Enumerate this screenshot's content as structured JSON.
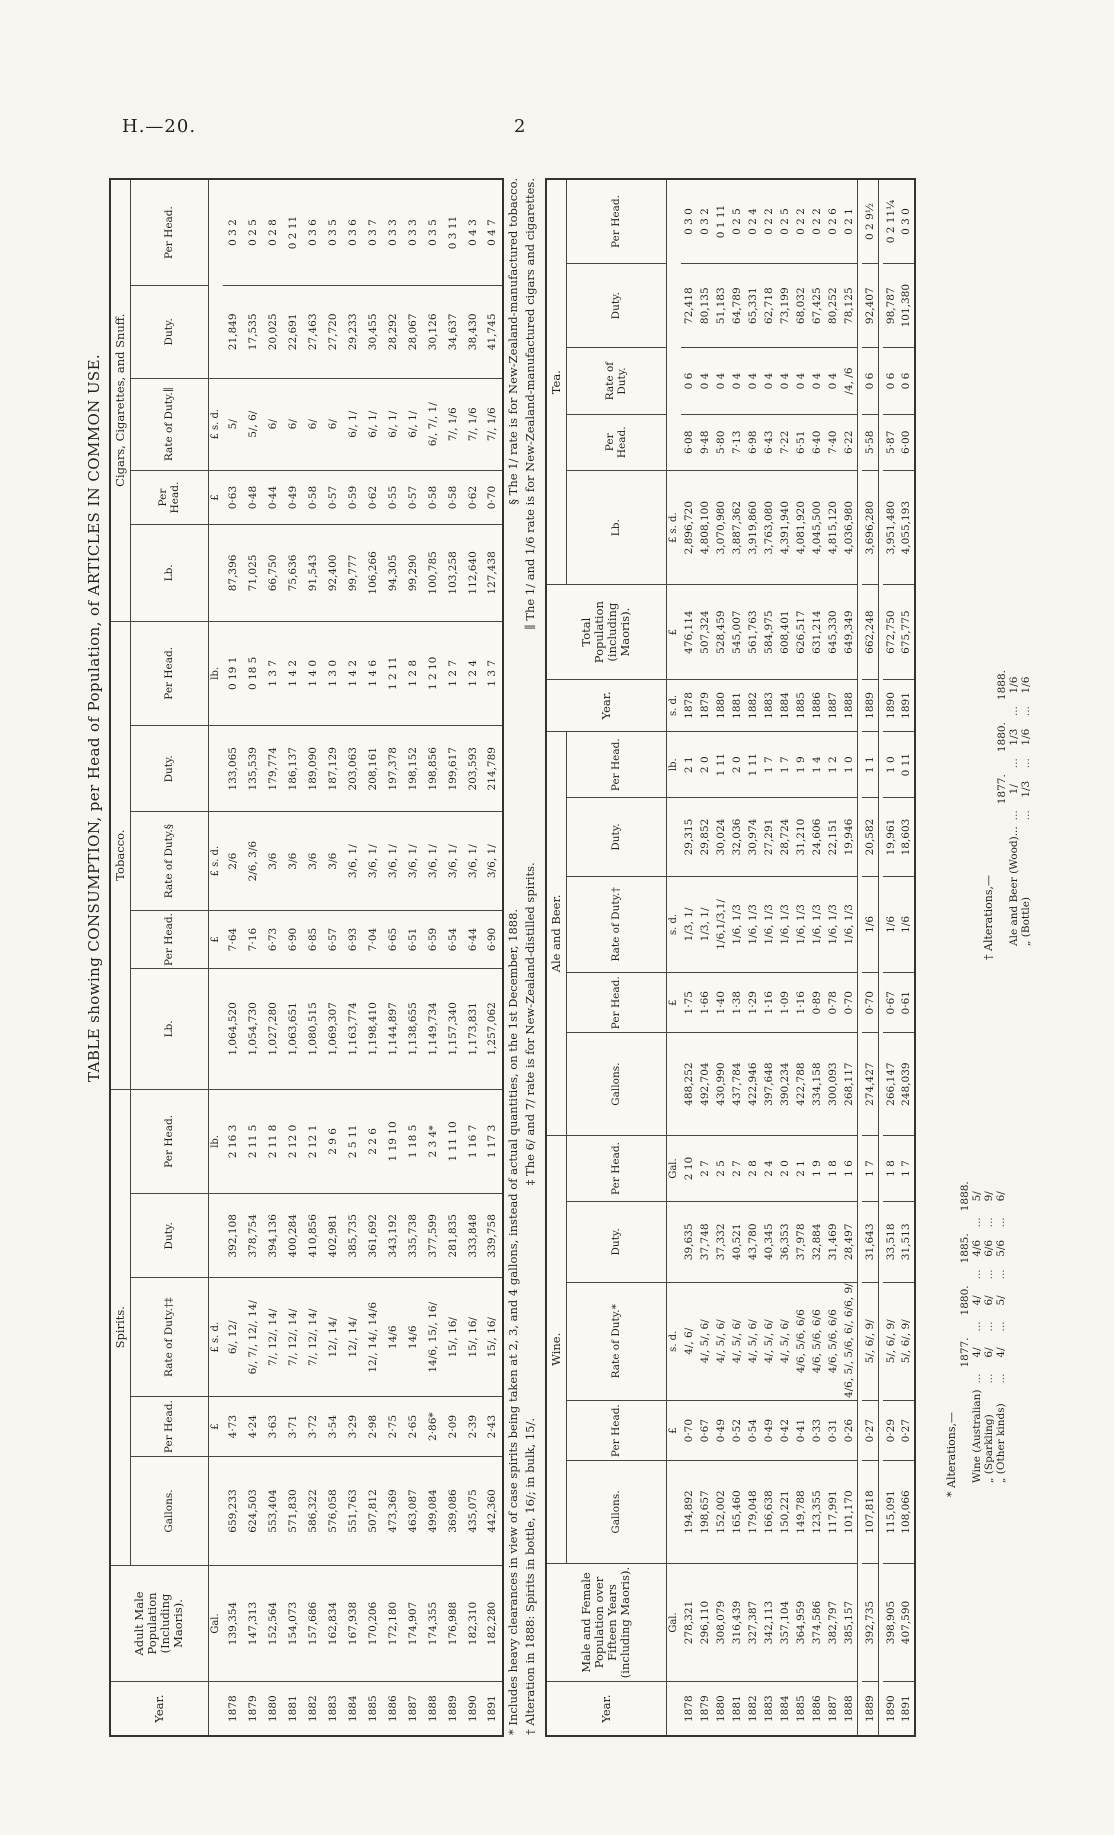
{
  "page": {
    "header_left": "H.—20.",
    "page_number": "2"
  },
  "title": "TABLE showing CONSUMPTION, per Head of Population, of ARTICLES IN COMMON USE.",
  "table1": {
    "head": {
      "year": "Year.",
      "pop": "Adult Male Population (Including Maoris)."
    },
    "groups": [
      "Spirits.",
      "Tobacco.",
      "Cigars, Cigarettes, and Snuff."
    ],
    "sub_headers": [
      "Gallons.",
      "Per Head.",
      "Rate of Duty.†‡",
      "Duty.",
      "Per Head.",
      "Lb.",
      "Per Head.",
      "Rate of Duty.§",
      "Duty.",
      "Per Head.",
      "Lb.",
      "Per Head.",
      "Rate of Duty.∥",
      "Duty.",
      "Per Head."
    ],
    "units": [
      "",
      "Gal.",
      "",
      "£",
      "£ s. d.",
      "",
      "lb.",
      "",
      "£",
      "£ s. d.",
      "",
      "lb.",
      "",
      "£",
      "£ s. d."
    ],
    "rows": [
      [
        "1878",
        "139,354",
        "659,233",
        "4·73",
        "6/, 12/",
        "392,108",
        "2 16 3",
        "1,064,520",
        "7·64",
        "2/6",
        "133,065",
        "0 19 1",
        "87,396",
        "0·63",
        "5/",
        "21,849",
        "0 3 2"
      ],
      [
        "1879",
        "147,313",
        "624,503",
        "4·24",
        "6/, 7/, 12/, 14/",
        "378,754",
        "2 11 5",
        "1,054,730",
        "7·16",
        "2/6, 3/6",
        "135,539",
        "0 18 5",
        "71,025",
        "0·48",
        "5/, 6/",
        "17,535",
        "0 2 5"
      ],
      [
        "1880",
        "152,564",
        "553,404",
        "3·63",
        "7/, 12/, 14/",
        "394,136",
        "2 11 8",
        "1,027,280",
        "6·73",
        "3/6",
        "179,774",
        "1 3 7",
        "66,750",
        "0·44",
        "6/",
        "20,025",
        "0 2 8"
      ],
      [
        "1881",
        "154,073",
        "571,830",
        "3·71",
        "7/, 12/, 14/",
        "400,284",
        "2 12 0",
        "1,063,651",
        "6·90",
        "3/6",
        "186,137",
        "1 4 2",
        "75,636",
        "0·49",
        "6/",
        "22,691",
        "0 2 11"
      ],
      [
        "1882",
        "157,686",
        "586,322",
        "3·72",
        "7/, 12/, 14/",
        "410,856",
        "2 12 1",
        "1,080,515",
        "6·85",
        "3/6",
        "189,090",
        "1 4 0",
        "91,543",
        "0·58",
        "6/",
        "27,463",
        "0 3 6"
      ],
      [
        "1883",
        "162,834",
        "576,058",
        "3·54",
        "12/, 14/",
        "402,981",
        "2 9 6",
        "1,069,307",
        "6·57",
        "3/6",
        "187,129",
        "1 3 0",
        "92,400",
        "0·57",
        "6/",
        "27,720",
        "0 3 5"
      ],
      [
        "1884",
        "167,938",
        "551,763",
        "3·29",
        "12/, 14/",
        "385,735",
        "2 5 11",
        "1,163,774",
        "6·93",
        "3/6, 1/",
        "203,063",
        "1 4 2",
        "99,777",
        "0·59",
        "6/, 1/",
        "29,233",
        "0 3 6"
      ],
      [
        "1885",
        "170,206",
        "507,812",
        "2·98",
        "12/, 14/, 14/6",
        "361,692",
        "2 2 6",
        "1,198,410",
        "7·04",
        "3/6, 1/",
        "208,161",
        "1 4 6",
        "106,266",
        "0·62",
        "6/, 1/",
        "30,455",
        "0 3 7"
      ],
      [
        "1886",
        "172,180",
        "473,369",
        "2·75",
        "14/6",
        "343,192",
        "1 19 10",
        "1,144,897",
        "6·65",
        "3/6, 1/",
        "197,378",
        "1 2 11",
        "94,305",
        "0·55",
        "6/, 1/",
        "28,292",
        "0 3 3"
      ],
      [
        "1887",
        "174,907",
        "463,087",
        "2·65",
        "14/6",
        "335,738",
        "1 18 5",
        "1,138,655",
        "6·51",
        "3/6, 1/",
        "198,152",
        "1 2 8",
        "99,290",
        "0·57",
        "6/, 1/",
        "28,067",
        "0 3 3"
      ],
      [
        "1888",
        "174,355",
        "499,084",
        "2·86*",
        "14/6, 15/, 16/",
        "377,599",
        "2 3 4*",
        "1,149,734",
        "6·59",
        "3/6, 1/",
        "198,856",
        "1 2 10",
        "100,785",
        "0·58",
        "6/, 7/, 1/",
        "30,126",
        "0 3 5"
      ],
      [
        "1889",
        "176,988",
        "369,086",
        "2·09",
        "15/, 16/",
        "281,835",
        "1 11 10",
        "1,157,340",
        "6·54",
        "3/6, 1/",
        "199,617",
        "1 2 7",
        "103,258",
        "0·58",
        "7/, 1/6",
        "34,637",
        "0 3 11"
      ],
      [
        "1890",
        "182,310",
        "435,075",
        "2·39",
        "15/, 16/",
        "333,848",
        "1 16 7",
        "1,173,831",
        "6·44",
        "3/6, 1/",
        "203,593",
        "1 2 4",
        "112,640",
        "0·62",
        "7/, 1/6",
        "38,430",
        "0 4 3"
      ],
      [
        "1891",
        "182,280",
        "442,360",
        "2·43",
        "15/, 16/",
        "339,758",
        "1 17 3",
        "1,257,062",
        "6·90",
        "3/6, 1/",
        "214,789",
        "1 3 7",
        "127,438",
        "0·70",
        "7/, 1/6",
        "41,745",
        "0 4 7"
      ]
    ]
  },
  "footnotes": {
    "line1a": "* Includes heavy clearances in view of case spirits being taken at 2, 3, and 4 gallons, instead of actual quantities, on the 1st December, 1888.",
    "line1b": "§ The 1/ rate is for New-Zealand-manufactured tobacco.",
    "line2a": "† Alteration in 1888: Spirits in bottle, 16/; in bulk, 15/.",
    "line2b": "‡ The 6/ and 7/ rate is for New-Zealand-distilled spirits.",
    "line2c": "∥ The 1/ and 1/6 rate is for New-Zealand-manufactured cigars and cigarettes."
  },
  "table2": {
    "head": {
      "year": "Year.",
      "pop": "Male and Female Population over Fifteen Years (includ­ing Maoris).",
      "year2": "Year.",
      "total": "Total Population (including Maoris)."
    },
    "groups": [
      "Wine.",
      "Ale and Beer.",
      "Tea."
    ],
    "sub_headers": [
      "Gallons.",
      "Per Head.",
      "Rate of Duty.*",
      "Duty.",
      "Per Head.",
      "Gallons.",
      "Per Head.",
      "Rate of Duty.†",
      "Duty.",
      "Per Head.",
      "Lb.",
      "Per Head.",
      "Rate of Duty.",
      "Duty.",
      "Per Head."
    ],
    "units": [
      "",
      "Gal.",
      "",
      "£",
      "s. d.",
      "",
      "Gal.",
      "",
      "£",
      "s. d.",
      "",
      "lb.",
      "s. d.",
      "£",
      "£ s. d."
    ],
    "rows": [
      [
        "1878",
        "278,321",
        "194,892",
        "0·70",
        "4/, 6/",
        "39,635",
        "2 10",
        "488,252",
        "1·75",
        "1/3, 1/",
        "29,315",
        "2 1",
        "1878",
        "476,114",
        "2,896,720",
        "6·08",
        "0 6",
        "72,418",
        "0 3 0"
      ],
      [
        "1879",
        "296,110",
        "198,657",
        "0·67",
        "4/, 5/, 6/",
        "37,748",
        "2 7",
        "492,704",
        "1·66",
        "1/3, 1/",
        "29,852",
        "2 0",
        "1879",
        "507,324",
        "4,808,100",
        "9·48",
        "0 4",
        "80,135",
        "0 3 2"
      ],
      [
        "1880",
        "308,079",
        "152,002",
        "0·49",
        "4/, 5/, 6/",
        "37,332",
        "2 5",
        "430,990",
        "1·40",
        "1/6,1/3,1/",
        "30,024",
        "1 11",
        "1880",
        "528,459",
        "3,070,980",
        "5·80",
        "0 4",
        "51,183",
        "0 1 11"
      ],
      [
        "1881",
        "316,439",
        "165,460",
        "0·52",
        "4/, 5/, 6/",
        "40,521",
        "2 7",
        "437,784",
        "1·38",
        "1/6, 1/3",
        "32,036",
        "2 0",
        "1881",
        "545,007",
        "3,887,362",
        "7·13",
        "0 4",
        "64,789",
        "0 2 5"
      ],
      [
        "1882",
        "327,387",
        "179,048",
        "0·54",
        "4/, 5/, 6/",
        "43,780",
        "2 8",
        "422,946",
        "1·29",
        "1/6, 1/3",
        "30,974",
        "1 11",
        "1882",
        "561,763",
        "3,919,860",
        "6·98",
        "0 4",
        "65,331",
        "0 2 4"
      ],
      [
        "1883",
        "342,113",
        "166,638",
        "0·49",
        "4/, 5/, 6/",
        "40,345",
        "2 4",
        "397,648",
        "1·16",
        "1/6, 1/3",
        "27,291",
        "1 7",
        "1883",
        "584,975",
        "3,763,080",
        "6·43",
        "0 4",
        "62,718",
        "0 2 2"
      ],
      [
        "1884",
        "357,104",
        "150,221",
        "0·42",
        "4/, 5/, 6/",
        "36,353",
        "2 0",
        "390,234",
        "1·09",
        "1/6, 1/3",
        "28,724",
        "1 7",
        "1884",
        "608,401",
        "4,391,940",
        "7·22",
        "0 4",
        "73,199",
        "0 2 5"
      ],
      [
        "1885",
        "364,959",
        "149,788",
        "0·41",
        "4/6, 5/6, 6/6",
        "37,978",
        "2 1",
        "422,788",
        "1·16",
        "1/6, 1/3",
        "31,210",
        "1 9",
        "1885",
        "626,517",
        "4,081,920",
        "6·51",
        "0 4",
        "68,032",
        "0 2 2"
      ],
      [
        "1886",
        "374,586",
        "123,355",
        "0·33",
        "4/6, 5/6, 6/6",
        "32,884",
        "1 9",
        "334,158",
        "0·89",
        "1/6, 1/3",
        "24,606",
        "1 4",
        "1886",
        "631,214",
        "4,045,500",
        "6·40",
        "0 4",
        "67,425",
        "0 2 2"
      ],
      [
        "1887",
        "382,797",
        "117,991",
        "0·31",
        "4/6, 5/6, 6/6",
        "31,469",
        "1 8",
        "300,093",
        "0·78",
        "1/6, 1/3",
        "22,151",
        "1 2",
        "1887",
        "645,330",
        "4,815,120",
        "7·40",
        "0 4",
        "80,252",
        "0 2 6"
      ],
      [
        "1888",
        "385,157",
        "101,170",
        "0·26",
        "4/6, 5/, 5/6, 6/, 6/6, 9/",
        "28,497",
        "1 6",
        "268,117",
        "0·70",
        "1/6, 1/3",
        "19,946",
        "1 0",
        "1888",
        "649,349",
        "4,036,980",
        "6·22",
        "/4, /6",
        "78,125",
        "0 2 1"
      ],
      [
        "1889",
        "392,735",
        "107,818",
        "0·27",
        "5/, 6/, 9/",
        "31,643",
        "1 7",
        "274,427",
        "0·70",
        "1/6",
        "20,582",
        "1 1",
        "1889",
        "662,248",
        "3,696,280",
        "5·58",
        "0 6",
        "92,407",
        "0 2 9½"
      ],
      [
        "1890",
        "398,905",
        "115,091",
        "0·29",
        "5/, 6/, 9/",
        "33,518",
        "1 8",
        "266,147",
        "0·67",
        "1/6",
        "19,961",
        "1 0",
        "1890",
        "672,750",
        "3,951,480",
        "5·87",
        "0 6",
        "98,787",
        "0 2 11¼"
      ],
      [
        "1891",
        "407,590",
        "108,066",
        "0·27",
        "5/, 6/, 9/",
        "31,513",
        "1 7",
        "248,039",
        "0·61",
        "1/6",
        "18,603",
        "0 11",
        "1891",
        "675,775",
        "4,055,193",
        "6·00",
        "0 6",
        "101,380",
        "0 3 0"
      ]
    ],
    "group_breaks": [
      11,
      12
    ]
  },
  "alterations_wine": {
    "title": "* Alterations,—",
    "years": [
      "1877.",
      "1880.",
      "1885.",
      "1888."
    ],
    "leader": "...",
    "rows": [
      {
        "label": "Wine (Australian)",
        "values": [
          "4/",
          "4/",
          "4/6",
          "5/"
        ]
      },
      {
        "label": "„   (Sparkling)",
        "values": [
          "6/",
          "6/",
          "6/6",
          "9/"
        ]
      },
      {
        "label": "„   (Other kinds)",
        "values": [
          "4/",
          "5/",
          "5/6",
          "6/"
        ]
      }
    ]
  },
  "alterations_ale_beer": {
    "title": "† Alterations,—",
    "years": [
      "1877.",
      "1880.",
      "1888."
    ],
    "leader": "...",
    "rows": [
      {
        "label": "Ale and Beer (Wood)...",
        "values": [
          "1/",
          "1/3",
          "1/6"
        ]
      },
      {
        "label": "„   (Bottle)",
        "values": [
          "1/3",
          "1/6",
          "1/6"
        ]
      }
    ]
  }
}
